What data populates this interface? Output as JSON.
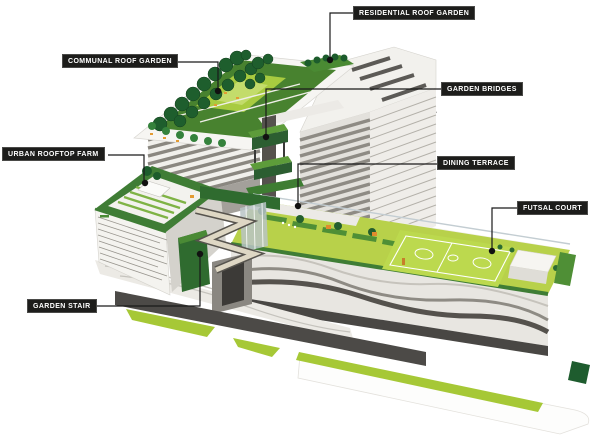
{
  "diagram": {
    "title": "Building greenery cutaway diagram",
    "annotations": [
      {
        "id": "residential-roof-garden",
        "label": "RESIDENTIAL ROOF GARDEN"
      },
      {
        "id": "communal-roof-garden",
        "label": "COMMUNAL ROOF GARDEN"
      },
      {
        "id": "garden-bridges",
        "label": "GARDEN BRIDGES"
      },
      {
        "id": "urban-rooftop-farm",
        "label": "URBAN ROOFTOP FARM"
      },
      {
        "id": "dining-terrace",
        "label": "DINING TERRACE"
      },
      {
        "id": "futsal-court",
        "label": "FUTSAL COURT"
      },
      {
        "id": "garden-stair",
        "label": "GARDEN STAIR"
      }
    ]
  },
  "colors": {
    "label_bg": "#1d1d1b",
    "label_text": "#ffffff",
    "leader_line": "#1a1a1a",
    "tree_green": "#1e5e2d",
    "roof_green": "#3f7d35",
    "lawn_green": "#b8d14a",
    "hedge_green": "#5d9c3a",
    "accent_stripe": "#a6c836",
    "road_gray": "#4c4a47",
    "building_white": "#f2f1ed",
    "facade_dark": "#8a8780",
    "furniture_orange": "#e39b33",
    "logo_blue": "#2a5fa5"
  }
}
